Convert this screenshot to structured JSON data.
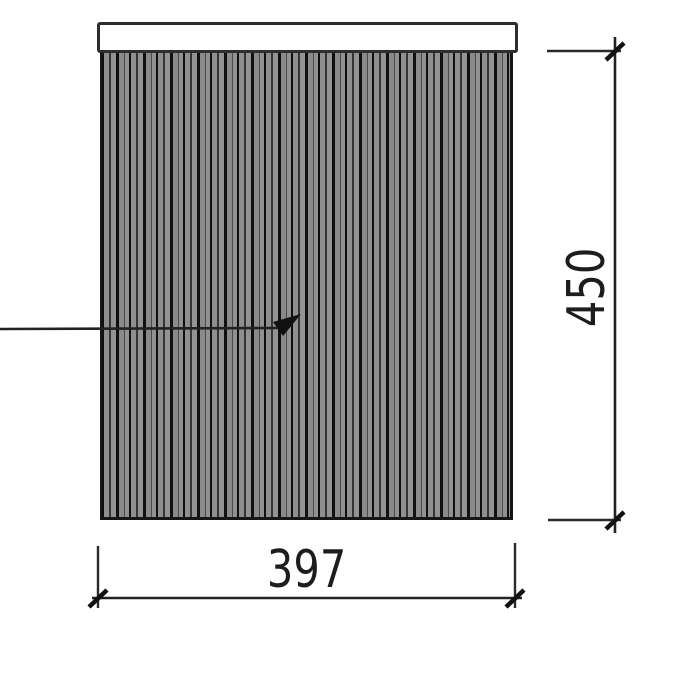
{
  "drawing": {
    "type": "technical-elevation-drawing",
    "dimensions": {
      "width_label": "397",
      "height_label": "450"
    },
    "colors": {
      "background": "#ffffff",
      "line": "#222222",
      "hatch_base": "#8f8f8f",
      "hatch_stripe": "#101010",
      "rail_fill": "#ffffff",
      "rail_border": "#2e2e2e",
      "text": "#1d1d1d"
    },
    "icons": {
      "leader_arrow": "filled arrowhead pointing up-right into hatched panel",
      "dimension_tick": "45-degree architectural tick slash"
    }
  }
}
